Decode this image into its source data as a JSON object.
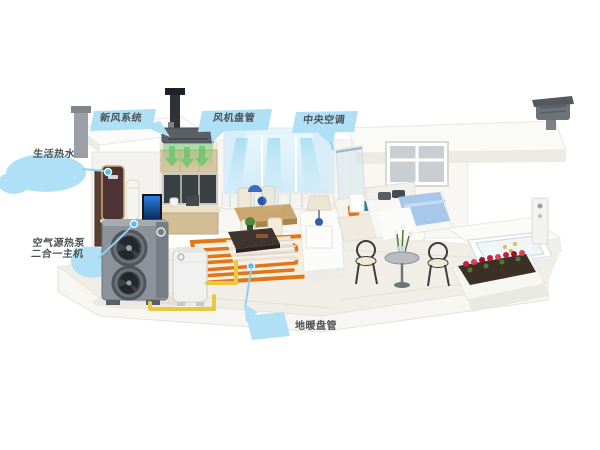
{
  "scene_title": "air-source heat pump whole-home system cutaway",
  "callouts": {
    "fresh_air": {
      "label": "新风系统"
    },
    "fan_coil": {
      "label": "风机盘管"
    },
    "central_ac": {
      "label": "中央空调"
    },
    "hot_water": {
      "label": "生活热水"
    },
    "heat_pump": {
      "line1": "空气源热泵",
      "line2": "二合一主机"
    },
    "floor_heating": {
      "label": "地暖盘管"
    }
  },
  "colors": {
    "background": "#ffffff",
    "callout_blue": "#b0e0f6",
    "leader_blue": "#8ed1f0",
    "anchor_dot_blue": "#5fbbea",
    "label_text": "#4b5156",
    "pipe_yellow": "#e9c83f",
    "coil_orange": "#e0761c",
    "heat_pump_gray": "#8b9299",
    "airflow_cyan": "#7fd0f0",
    "fresh_air_green": "#5ac464",
    "bed_blue": "#a9c7ea",
    "flower_red": "#c2203e"
  }
}
